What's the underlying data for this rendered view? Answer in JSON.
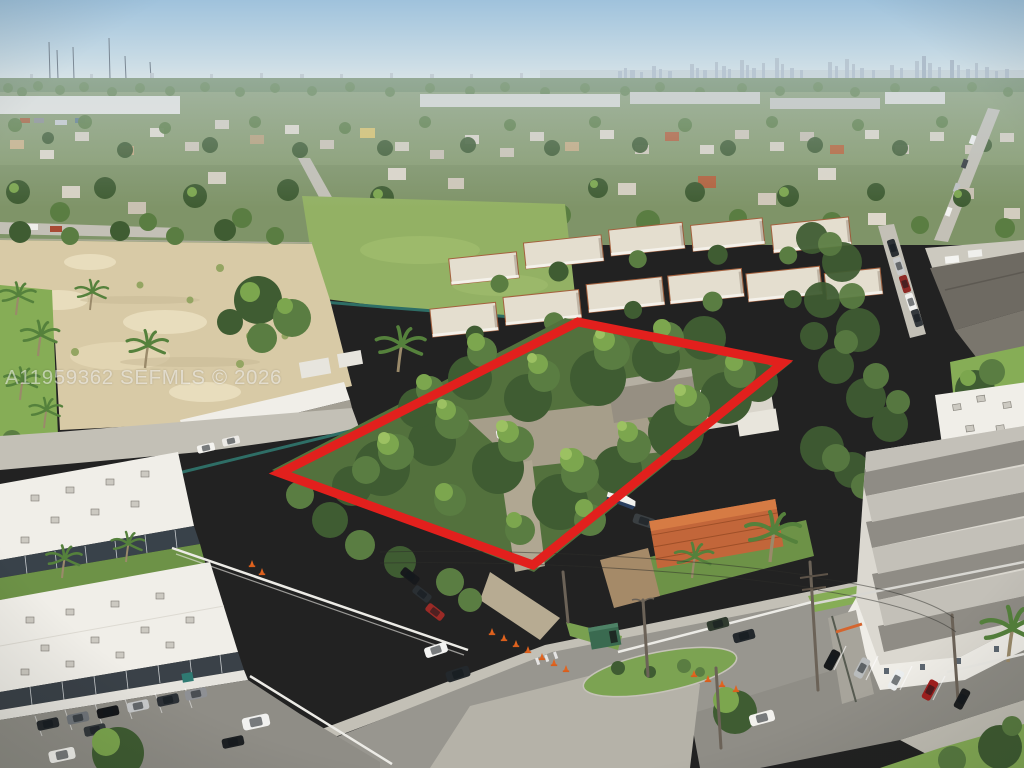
{
  "meta": {
    "type": "aerial-listing-photo",
    "width": 1024,
    "height": 768,
    "description": "Aerial drone photo of a wooded vacant parcel outlined in red, bordered by apartment buildings, a condo complex, streets with parked cars and traffic cones, a sandy cleared lot, and a city skyline on the horizon."
  },
  "watermark": {
    "text": "A11959362 SEFMLS © 2026"
  },
  "boundary": {
    "points": "578,322 783,363 533,565 280,473",
    "color": "#e2201d",
    "stroke_width": 9
  },
  "palette": {
    "sky_top": "#9fc2dc",
    "sky_horizon": "#dde6e8",
    "skyline": "#b3c2cf",
    "far_trees": "#6e8a5e",
    "tree_dark": "#3f5c32",
    "tree_mid": "#5a7d42",
    "tree_light": "#7ca64e",
    "sand": "#d8caa6",
    "asphalt": "#98968f",
    "concrete": "#c3c0b6",
    "sunlit_grass": "#86ad56",
    "white_roof": "#f0eee8",
    "terracotta_roof": "#c2663a",
    "teal_fence": "#2e6e66",
    "boundary_red": "#e2201d",
    "cone_orange": "#e2641f"
  }
}
